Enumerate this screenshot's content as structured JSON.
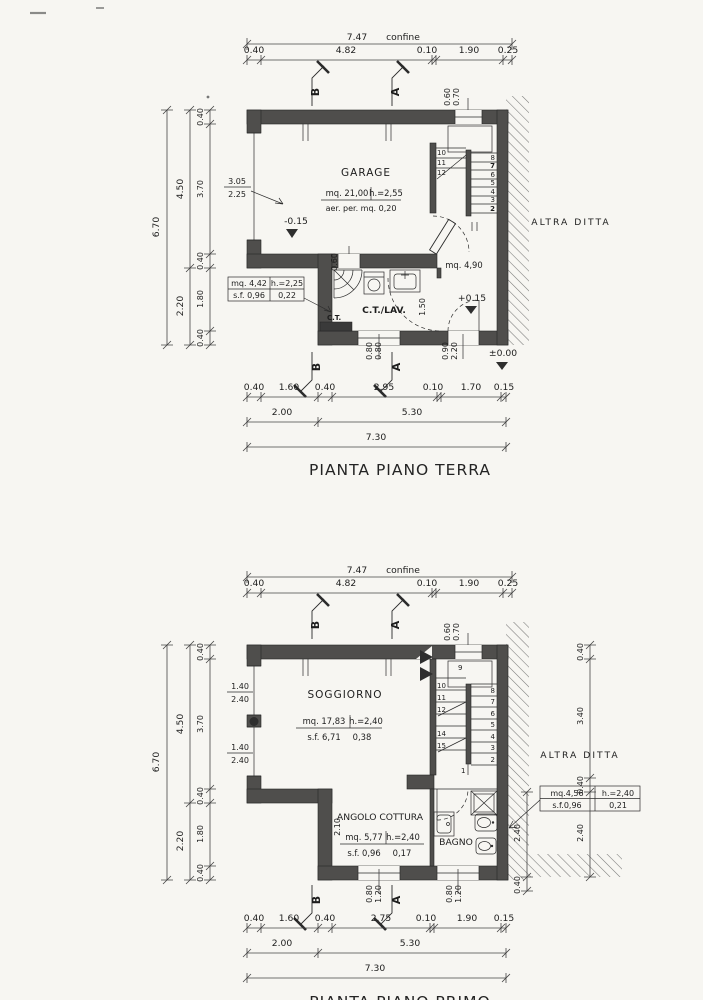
{
  "p1": {
    "title": "PIANTA PIANO TERRA",
    "dim_overall_top": "7.47",
    "confine": "confine",
    "dims_top": [
      "0.40",
      "4.82",
      "0.10",
      "1.90",
      "0.25"
    ],
    "win_top_w": "0.60",
    "win_top_h": "0.70",
    "dim_left_total": "6.70",
    "dims_left_mid": [
      "4.50",
      "2.20"
    ],
    "dims_left_inner": [
      "0.40",
      "3.70",
      "0.40",
      "1.80",
      "0.40"
    ],
    "garage": {
      "name": "GARAGE",
      "mq": "mq. 21,00",
      "h": "h.=2,55",
      "aer": "aer. per. mq. 0,20",
      "level": "-0.15",
      "door_w": "3.05",
      "door_h": "2.25"
    },
    "stairs_left": [
      "10",
      "11",
      "12"
    ],
    "stairs_right": [
      "8",
      "7",
      "6",
      "5",
      "4",
      "3",
      "2"
    ],
    "ctlav": {
      "name": "C.T./LAV.",
      "ct": "C.T.",
      "vent": "0.60",
      "mq": "mq. 4,42",
      "h": "h.=2,25",
      "sf": "s.f. 0,96",
      "sf_val": "0,22",
      "opening": "1.50"
    },
    "entry": {
      "mq": "mq. 4,90",
      "level": "+0.15",
      "door_w": "0.90",
      "door_h": "2.20",
      "win_w": "0.80",
      "win_h": "0.80",
      "ground": "±0.00"
    },
    "neighbor": "ALTRA DITTA",
    "dims_bottom": [
      "0.40",
      "1.60",
      "0.40",
      "2.95",
      "0.10",
      "1.70",
      "0.15"
    ],
    "dims_bottom_mid": [
      "2.00",
      "5.30"
    ],
    "dim_overall_bottom": "7.30",
    "marker_a": "A",
    "marker_b": "B"
  },
  "p2": {
    "title": "PIANTA PIANO PRIMO",
    "dim_overall_top": "7.47",
    "confine": "confine",
    "dims_top": [
      "0.40",
      "4.82",
      "0.10",
      "1.90",
      "0.25"
    ],
    "win_top_w": "0.60",
    "win_top_h": "0.70",
    "dim_left_total": "6.70",
    "dims_left_mid": [
      "4.50",
      "2.20"
    ],
    "dims_left_inner": [
      "0.40",
      "3.70",
      "0.40",
      "1.80",
      "0.40"
    ],
    "dims_right": [
      "0.40",
      "3.40",
      "0.40",
      "2.40"
    ],
    "dims_right_inner": [
      "2.40",
      "0.40"
    ],
    "soggiorno": {
      "name": "SOGGIORNO",
      "mq": "mq. 17,83",
      "h": "h.=2,40",
      "sf": "s.f. 6,71",
      "sf_val": "0,38",
      "win_w": "1.40",
      "win_h": "2.40"
    },
    "stairs_top": "9",
    "stairs_left": [
      "10",
      "11",
      "12",
      "14",
      "15"
    ],
    "stairs_right": [
      "8",
      "7",
      "6",
      "5",
      "4",
      "3",
      "2"
    ],
    "stairs_bottom": "1",
    "cottura": {
      "name": "ANGOLO COTTURA",
      "mq": "mq. 5,77",
      "h": "h.=2,40",
      "sf": "s.f. 0,96",
      "sf_val": "0,17",
      "depth": "2.10"
    },
    "bagno": {
      "name": "BAGNO",
      "mq": "mq.4,56",
      "h": "h.=2,40",
      "sf": "s.f.0,96",
      "sf_val": "0,21"
    },
    "win_bottom_w": "0.80",
    "win_bottom_h": "1.20",
    "neighbor": "ALTRA DITTA",
    "dims_bottom": [
      "0.40",
      "1.60",
      "0.40",
      "2.75",
      "0.10",
      "1.90",
      "0.15"
    ],
    "dims_bottom_mid": [
      "2.00",
      "5.30"
    ],
    "dim_overall_bottom": "7.30",
    "marker_a": "A",
    "marker_b": "B"
  }
}
